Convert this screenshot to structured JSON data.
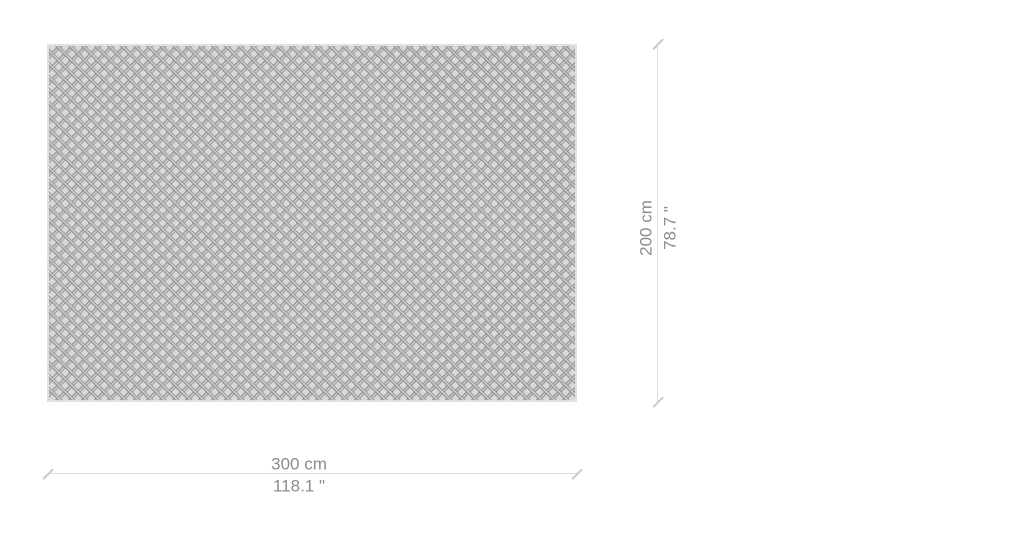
{
  "scene": {
    "description": "Rug size diagram with dimension lines",
    "background_color": "#ffffff"
  },
  "rug": {
    "pattern": "diamond-lattice",
    "base_color": "#d8d8d8",
    "lattice_color": "#949494",
    "trim_color": "#e8e8e8"
  },
  "dimensions": {
    "width": {
      "cm": "300 cm",
      "inches": "118.1 \""
    },
    "height": {
      "cm": "200 cm",
      "inches": "78.7 \""
    }
  },
  "style": {
    "dimension_line_color": "#dcdcdc",
    "tick_color": "#c9c9c9",
    "label_color": "#8c8c8c"
  }
}
